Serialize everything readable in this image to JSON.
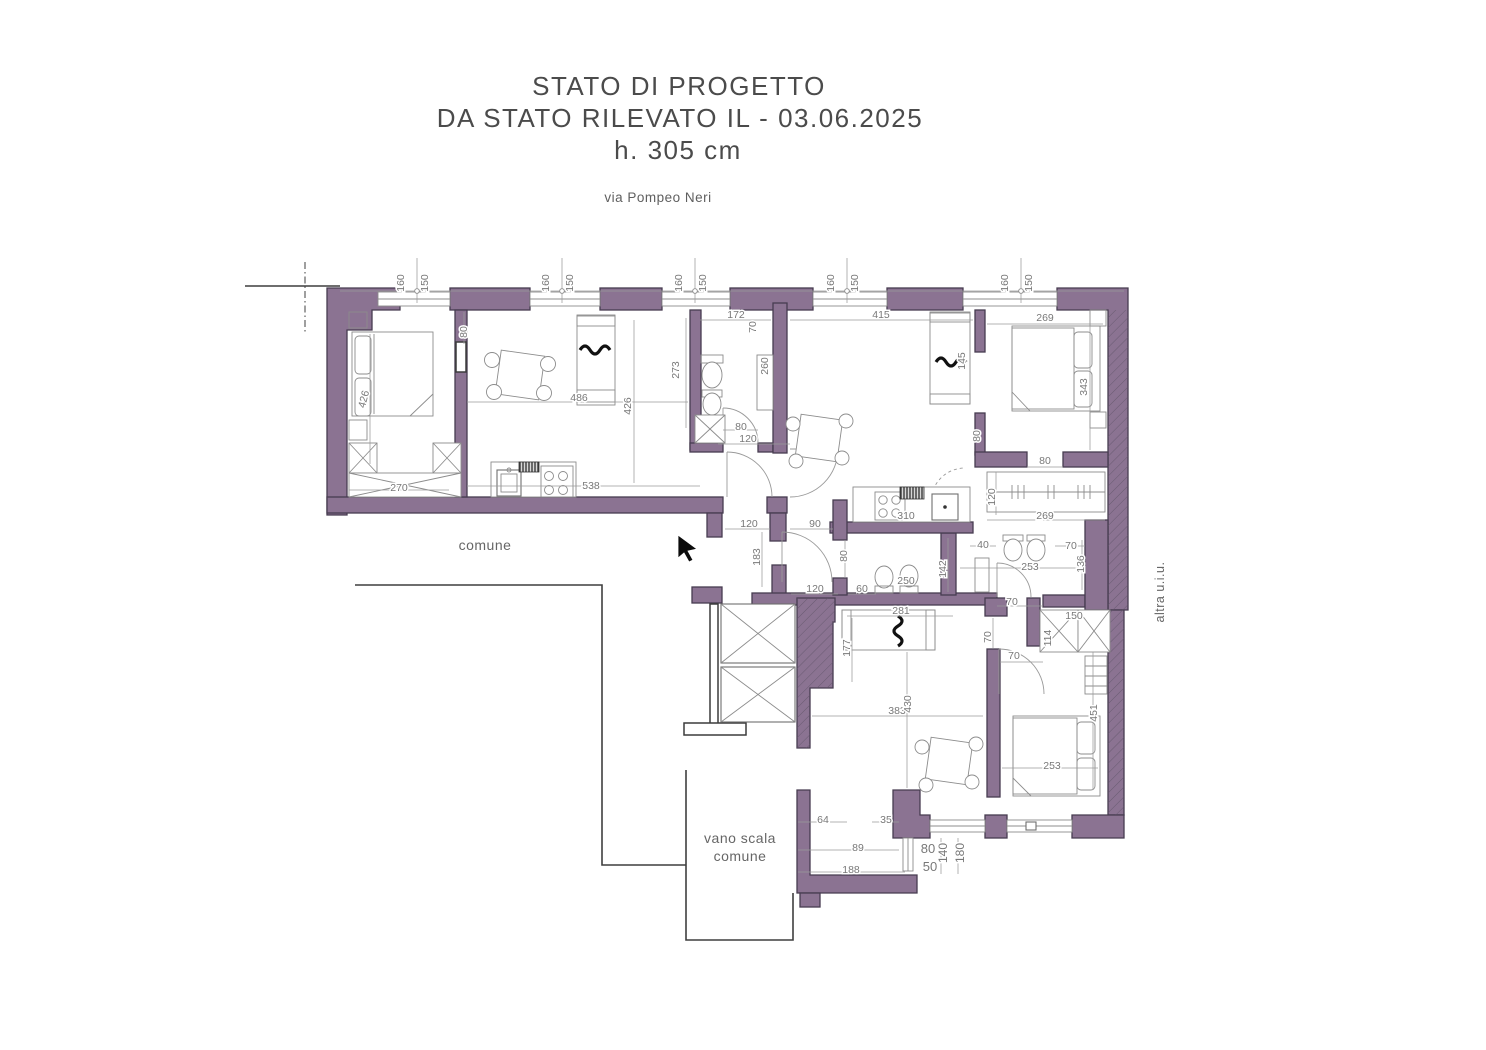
{
  "title": {
    "line1": "STATO DI PROGETTO",
    "line2": "DA STATO RILEVATO IL - 03.06.2025",
    "line3": "h. 305 cm",
    "address": "via Pompeo Neri"
  },
  "labels": {
    "corridor": "comune",
    "stairwell_line1": "vano scala",
    "stairwell_line2": "comune",
    "other_unit": "altra u.i.u."
  },
  "colors": {
    "wall": "#8b7392",
    "wall_outline": "#473c50",
    "drawing_line": "#8c8c8c",
    "dimension_text": "#787878",
    "title_text": "#4b4b4b"
  },
  "dims": {
    "w1a": "160",
    "w1b": "150",
    "w2a": "160",
    "w2b": "150",
    "w3a": "160",
    "w3b": "150",
    "w4a": "160",
    "w4b": "150",
    "w5a": "160",
    "w5b": "150",
    "part_door": "80",
    "bed1": "426",
    "ward1": "270",
    "sofa1": "486",
    "liv1": "426",
    "kitchen1": "538",
    "bath1_h": "273",
    "bath1_w": "172",
    "bath1_d": "70",
    "bath1_cab": "260",
    "bath1_door": "80",
    "bath1_ext": "120",
    "liv2": "415",
    "bed2_w": "269",
    "bed2_h": "343",
    "sofa2": "145",
    "bed2_door": "80",
    "ward2_open": "80",
    "ward2_d": "120",
    "ward2_w": "269",
    "kitchen2": "310",
    "hall_w": "90",
    "hall_door1": "120",
    "hall_h": "183",
    "hall_door2": "80",
    "hall_door3": "120",
    "wc1_w": "60",
    "wc1_len": "250",
    "bath2_a": "40",
    "bath2_b": "70",
    "bath2_w": "253",
    "bath2_h": "136",
    "bath2_d": "142",
    "bath2_door": "70",
    "sofa3_w": "281",
    "sofa3_h": "177",
    "bed3_door": "70",
    "bed3_gap": "70",
    "bed3_d70": "70",
    "ward3_w": "150",
    "ward3_h": "114",
    "liv3_w": "383",
    "liv3_h": "430",
    "bed3_w": "253",
    "bed3_h": "451",
    "s64": "64",
    "s35": "35",
    "s89": "89",
    "s188": "188",
    "win_v80": "80",
    "win_v50": "50",
    "win140": "140",
    "win180": "180"
  }
}
